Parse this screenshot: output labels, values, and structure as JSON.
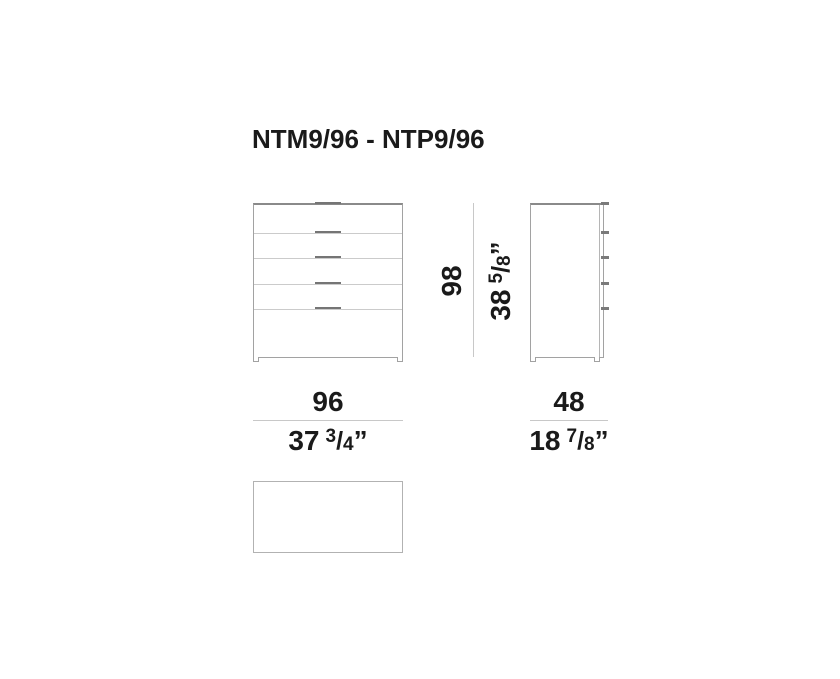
{
  "title": {
    "text": "NTM9/96 - NTP9/96"
  },
  "symbols": {
    "fraction_slash": "/",
    "inch_mark": "”"
  },
  "colors": {
    "text": "#1a1a1a",
    "cabinet_outline": "#a2a2a2",
    "cabinet_top_edge": "#8a8a8a",
    "drawer_divider": "#cbcbcb",
    "handle": "#757575",
    "dimension_line": "#c8c8c8",
    "plan_outline": "#b2b2b2",
    "background": "#ffffff"
  },
  "drawing": {
    "front_view": {
      "drawer_count": 5
    },
    "side_view": {
      "drawer_count": 5
    }
  },
  "dimensions": {
    "width": {
      "cm": "96",
      "inches_whole": "37",
      "inches_numerator": "3",
      "inches_denominator": "4"
    },
    "height": {
      "cm": "98",
      "inches_whole": "38",
      "inches_numerator": "5",
      "inches_denominator": "8"
    },
    "depth": {
      "cm": "48",
      "inches_whole": "18",
      "inches_numerator": "7",
      "inches_denominator": "8"
    }
  }
}
